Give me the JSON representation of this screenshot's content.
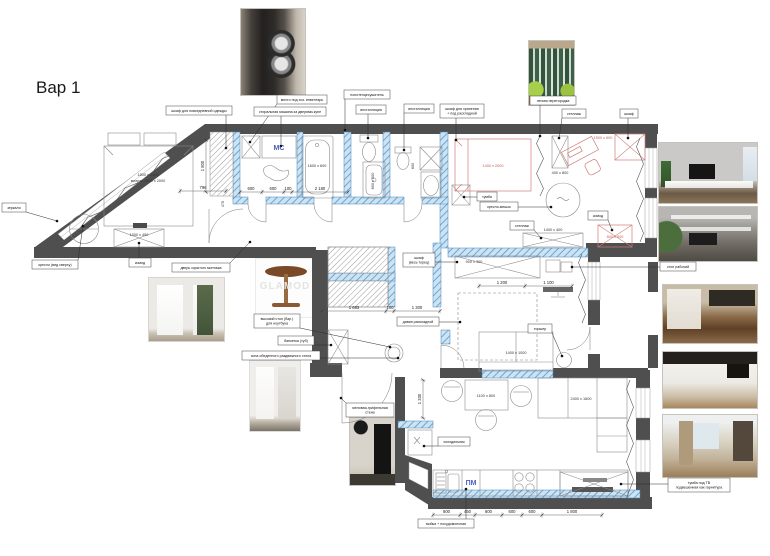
{
  "title": "Вар 1",
  "watermark": "GLAMOD",
  "colors": {
    "wall": "#4f4f4f",
    "blue_wall": "#cde3f2",
    "blue_wall_stripe": "#6aa6d8",
    "blue_wall_stroke": "#4a86b8",
    "red_furniture": "#cf7d78",
    "red_text": "#c2605c",
    "furniture": "#8a8a8a",
    "leader": "#2a2a2a",
    "dimension": "#555555",
    "room_label_blue": "#4a5fc0"
  },
  "rooms": {
    "washing_machine": "МС",
    "dishwasher": "ПМ"
  },
  "photos": [
    "laundry-room",
    "glass-partition",
    "tv-wall-living",
    "shelving-wall",
    "kitchen-wood",
    "kitchen-white",
    "kitchen-beige",
    "hidden-door",
    "white-wardrobe",
    "chalkboard-cafe",
    "pedestal-table"
  ],
  "callouts": [
    {
      "n": "everyday-wardrobe",
      "t": "шкаф для повседневной одежды",
      "x": 166,
      "y": 106,
      "w": 66,
      "h": 9,
      "dx": 226,
      "dy": 148
    },
    {
      "n": "inventory-place",
      "t": "место под хоз. инвентарь",
      "x": 277,
      "y": 95,
      "w": 50,
      "h": 9,
      "dx": 250,
      "dy": 142
    },
    {
      "n": "washer-note",
      "t": "стиральная машина за дверями-купе",
      "x": 254,
      "y": 107,
      "w": 72,
      "h": 9,
      "dx": 281,
      "dy": 146
    },
    {
      "n": "towel-dryer",
      "t": "полотенцесушитель",
      "x": 344,
      "y": 90,
      "w": 46,
      "h": 9,
      "dx": 345,
      "dy": 130
    },
    {
      "n": "installation-1",
      "t": "инсталляция",
      "x": 356,
      "y": 105,
      "w": 30,
      "h": 9,
      "dx": 368,
      "dy": 138
    },
    {
      "n": "installation-2",
      "t": "инсталляция",
      "x": 404,
      "y": 104,
      "w": 30,
      "h": 9,
      "dx": 404,
      "dy": 150
    },
    {
      "n": "storage-wardrobe",
      "t": "шкаф для хранения\n+ под раскладной",
      "x": 440,
      "y": 104,
      "w": 44,
      "h": 14,
      "dx": 456,
      "dy": 140
    },
    {
      "n": "light-partition",
      "t": "легкая перегородка",
      "x": 530,
      "y": 96,
      "w": 46,
      "h": 9,
      "dx": 540,
      "dy": 136
    },
    {
      "n": "shelf-unit",
      "t": "стеллаж",
      "x": 562,
      "y": 109,
      "w": 24,
      "h": 9,
      "dx": 559,
      "dy": 138
    },
    {
      "n": "wardrobe-small",
      "t": "шкаф",
      "x": 620,
      "y": 109,
      "w": 18,
      "h": 9,
      "dx": 628,
      "dy": 138
    },
    {
      "n": "beanbag",
      "t": "кресло-мешок",
      "x": 480,
      "y": 202,
      "w": 38,
      "h": 9,
      "dx": 551,
      "dy": 207
    },
    {
      "n": "tumba",
      "t": "тумба",
      "x": 477,
      "y": 192,
      "w": 20,
      "h": 9,
      "dx": 464,
      "dy": 197
    },
    {
      "n": "komod-red",
      "t": "комод",
      "x": 588,
      "y": 211,
      "w": 20,
      "h": 9,
      "dx": 612,
      "dy": 230
    },
    {
      "n": "shelving-2",
      "t": "стеллаж",
      "x": 510,
      "y": 221,
      "w": 24,
      "h": 9,
      "dx": 541,
      "dy": 238
    },
    {
      "n": "wardrobe-full",
      "t": "шкаф\n(весь торец)",
      "x": 403,
      "y": 253,
      "w": 32,
      "h": 14,
      "dx": 457,
      "dy": 262
    },
    {
      "n": "folding-sofa",
      "t": "диван раскладной",
      "x": 397,
      "y": 317,
      "w": 42,
      "h": 9,
      "dx": 460,
      "dy": 322
    },
    {
      "n": "floor-lamp",
      "t": "торшер",
      "x": 528,
      "y": 324,
      "w": 24,
      "h": 9,
      "dx": 562,
      "dy": 356
    },
    {
      "n": "work-desk",
      "t": "стол рабочий",
      "x": 660,
      "y": 262,
      "w": 36,
      "h": 9,
      "dx": 572,
      "dy": 267
    },
    {
      "n": "laptop-table",
      "t": "высокий стол (бар.)\nдля ноутбука",
      "x": 254,
      "y": 314,
      "w": 46,
      "h": 14,
      "dx": 390,
      "dy": 347
    },
    {
      "n": "banketka",
      "t": "банкетка (туб)",
      "x": 278,
      "y": 336,
      "w": 36,
      "h": 9,
      "dx": 331,
      "dy": 345
    },
    {
      "n": "dining-zone",
      "t": "зона обеденного раздвижного стола",
      "x": 242,
      "y": 351,
      "w": 78,
      "h": 9,
      "dx": 398,
      "dy": 358
    },
    {
      "n": "chalk-wall",
      "t": "меловая-грифельная\nстена",
      "x": 346,
      "y": 403,
      "w": 48,
      "h": 14,
      "dx": 341,
      "dy": 398
    },
    {
      "n": "fridge",
      "t": "холодильник",
      "x": 438,
      "y": 437,
      "w": 32,
      "h": 9,
      "dx": 424,
      "dy": 446
    },
    {
      "n": "sink-dishwasher",
      "t": "мойка + посудомоечная",
      "x": 418,
      "y": 519,
      "w": 56,
      "h": 9,
      "dx": 466,
      "dy": 489
    },
    {
      "n": "tv-cabinet",
      "t": "тумба под ТВ\nподвешенная как гарнитура",
      "x": 668,
      "y": 478,
      "w": 62,
      "h": 14,
      "dx": 621,
      "dy": 484
    },
    {
      "n": "hidden-door",
      "t": "дверь скрытого монтажа",
      "x": 172,
      "y": 263,
      "w": 58,
      "h": 9,
      "dx": 250,
      "dy": 242
    },
    {
      "n": "armchair-label",
      "t": "кресло (вид сверху)",
      "x": 32,
      "y": 260,
      "w": 46,
      "h": 9,
      "dx": 83,
      "dy": 226
    },
    {
      "n": "komod-bedroom",
      "t": "комод",
      "x": 129,
      "y": 258,
      "w": 22,
      "h": 9,
      "dx": 139,
      "dy": 243
    },
    {
      "n": "mirror",
      "t": "зеркало",
      "x": 2,
      "y": 203,
      "w": 24,
      "h": 9,
      "dx": 57,
      "dy": 221
    }
  ],
  "chains": [
    {
      "y": 191,
      "ticks": [
        180,
        226
      ],
      "labels": [
        "796"
      ]
    },
    {
      "y": 192,
      "ticks": [
        240,
        262,
        284,
        292,
        348
      ],
      "labels": [
        "600",
        "600",
        "100",
        "2 180"
      ]
    },
    {
      "y": 286,
      "ticks": [
        479,
        525,
        572
      ],
      "labels": [
        "1 200",
        "1 100"
      ]
    },
    {
      "y": 311,
      "ticks": [
        322,
        386,
        394,
        440
      ],
      "labels": [
        "1 683",
        "100",
        "1 300"
      ]
    },
    {
      "y": 515,
      "ticks": [
        433,
        460,
        475,
        502,
        522,
        542,
        602
      ],
      "labels": [
        "800",
        "450",
        "800",
        "600",
        "600",
        "1 800"
      ]
    }
  ],
  "vchains": [
    {
      "x": 206,
      "ticks": [
        140,
        192
      ],
      "labels": [
        "1 800"
      ]
    },
    {
      "x": 423,
      "ticks": [
        380,
        418
      ],
      "labels": [
        "1 330"
      ]
    }
  ],
  "texts": [
    {
      "t": "1800 х 2100",
      "x": 148,
      "y": 176
    },
    {
      "t": "матрас 1600 х 2000",
      "x": 148,
      "y": 182
    },
    {
      "t": "1000 х 450",
      "x": 139,
      "y": 236
    },
    {
      "t": "1600 х 600",
      "x": 317,
      "y": 167
    },
    {
      "t": "800 х 500",
      "x": 374,
      "y": 181,
      "r": -90
    },
    {
      "t": "1400 х 2000",
      "x": 493,
      "y": 167,
      "c": "red"
    },
    {
      "t": "1500 х 600",
      "x": 603,
      "y": 139,
      "c": "red"
    },
    {
      "t": "400 х 800",
      "x": 560,
      "y": 174
    },
    {
      "t": "800 х 600",
      "x": 615,
      "y": 238,
      "c": "red"
    },
    {
      "t": "1400 х 400",
      "x": 553,
      "y": 231
    },
    {
      "t": "900 х 300",
      "x": 474,
      "y": 263
    },
    {
      "t": "1400 х 1000",
      "x": 516,
      "y": 354
    },
    {
      "t": "1100 х 800",
      "x": 486,
      "y": 397
    },
    {
      "t": "2400 х 1600",
      "x": 581,
      "y": 400
    },
    {
      "t": "475",
      "x": 224,
      "y": 204,
      "r": -90
    },
    {
      "t": "600",
      "x": 414,
      "y": 166,
      "r": -90
    }
  ]
}
